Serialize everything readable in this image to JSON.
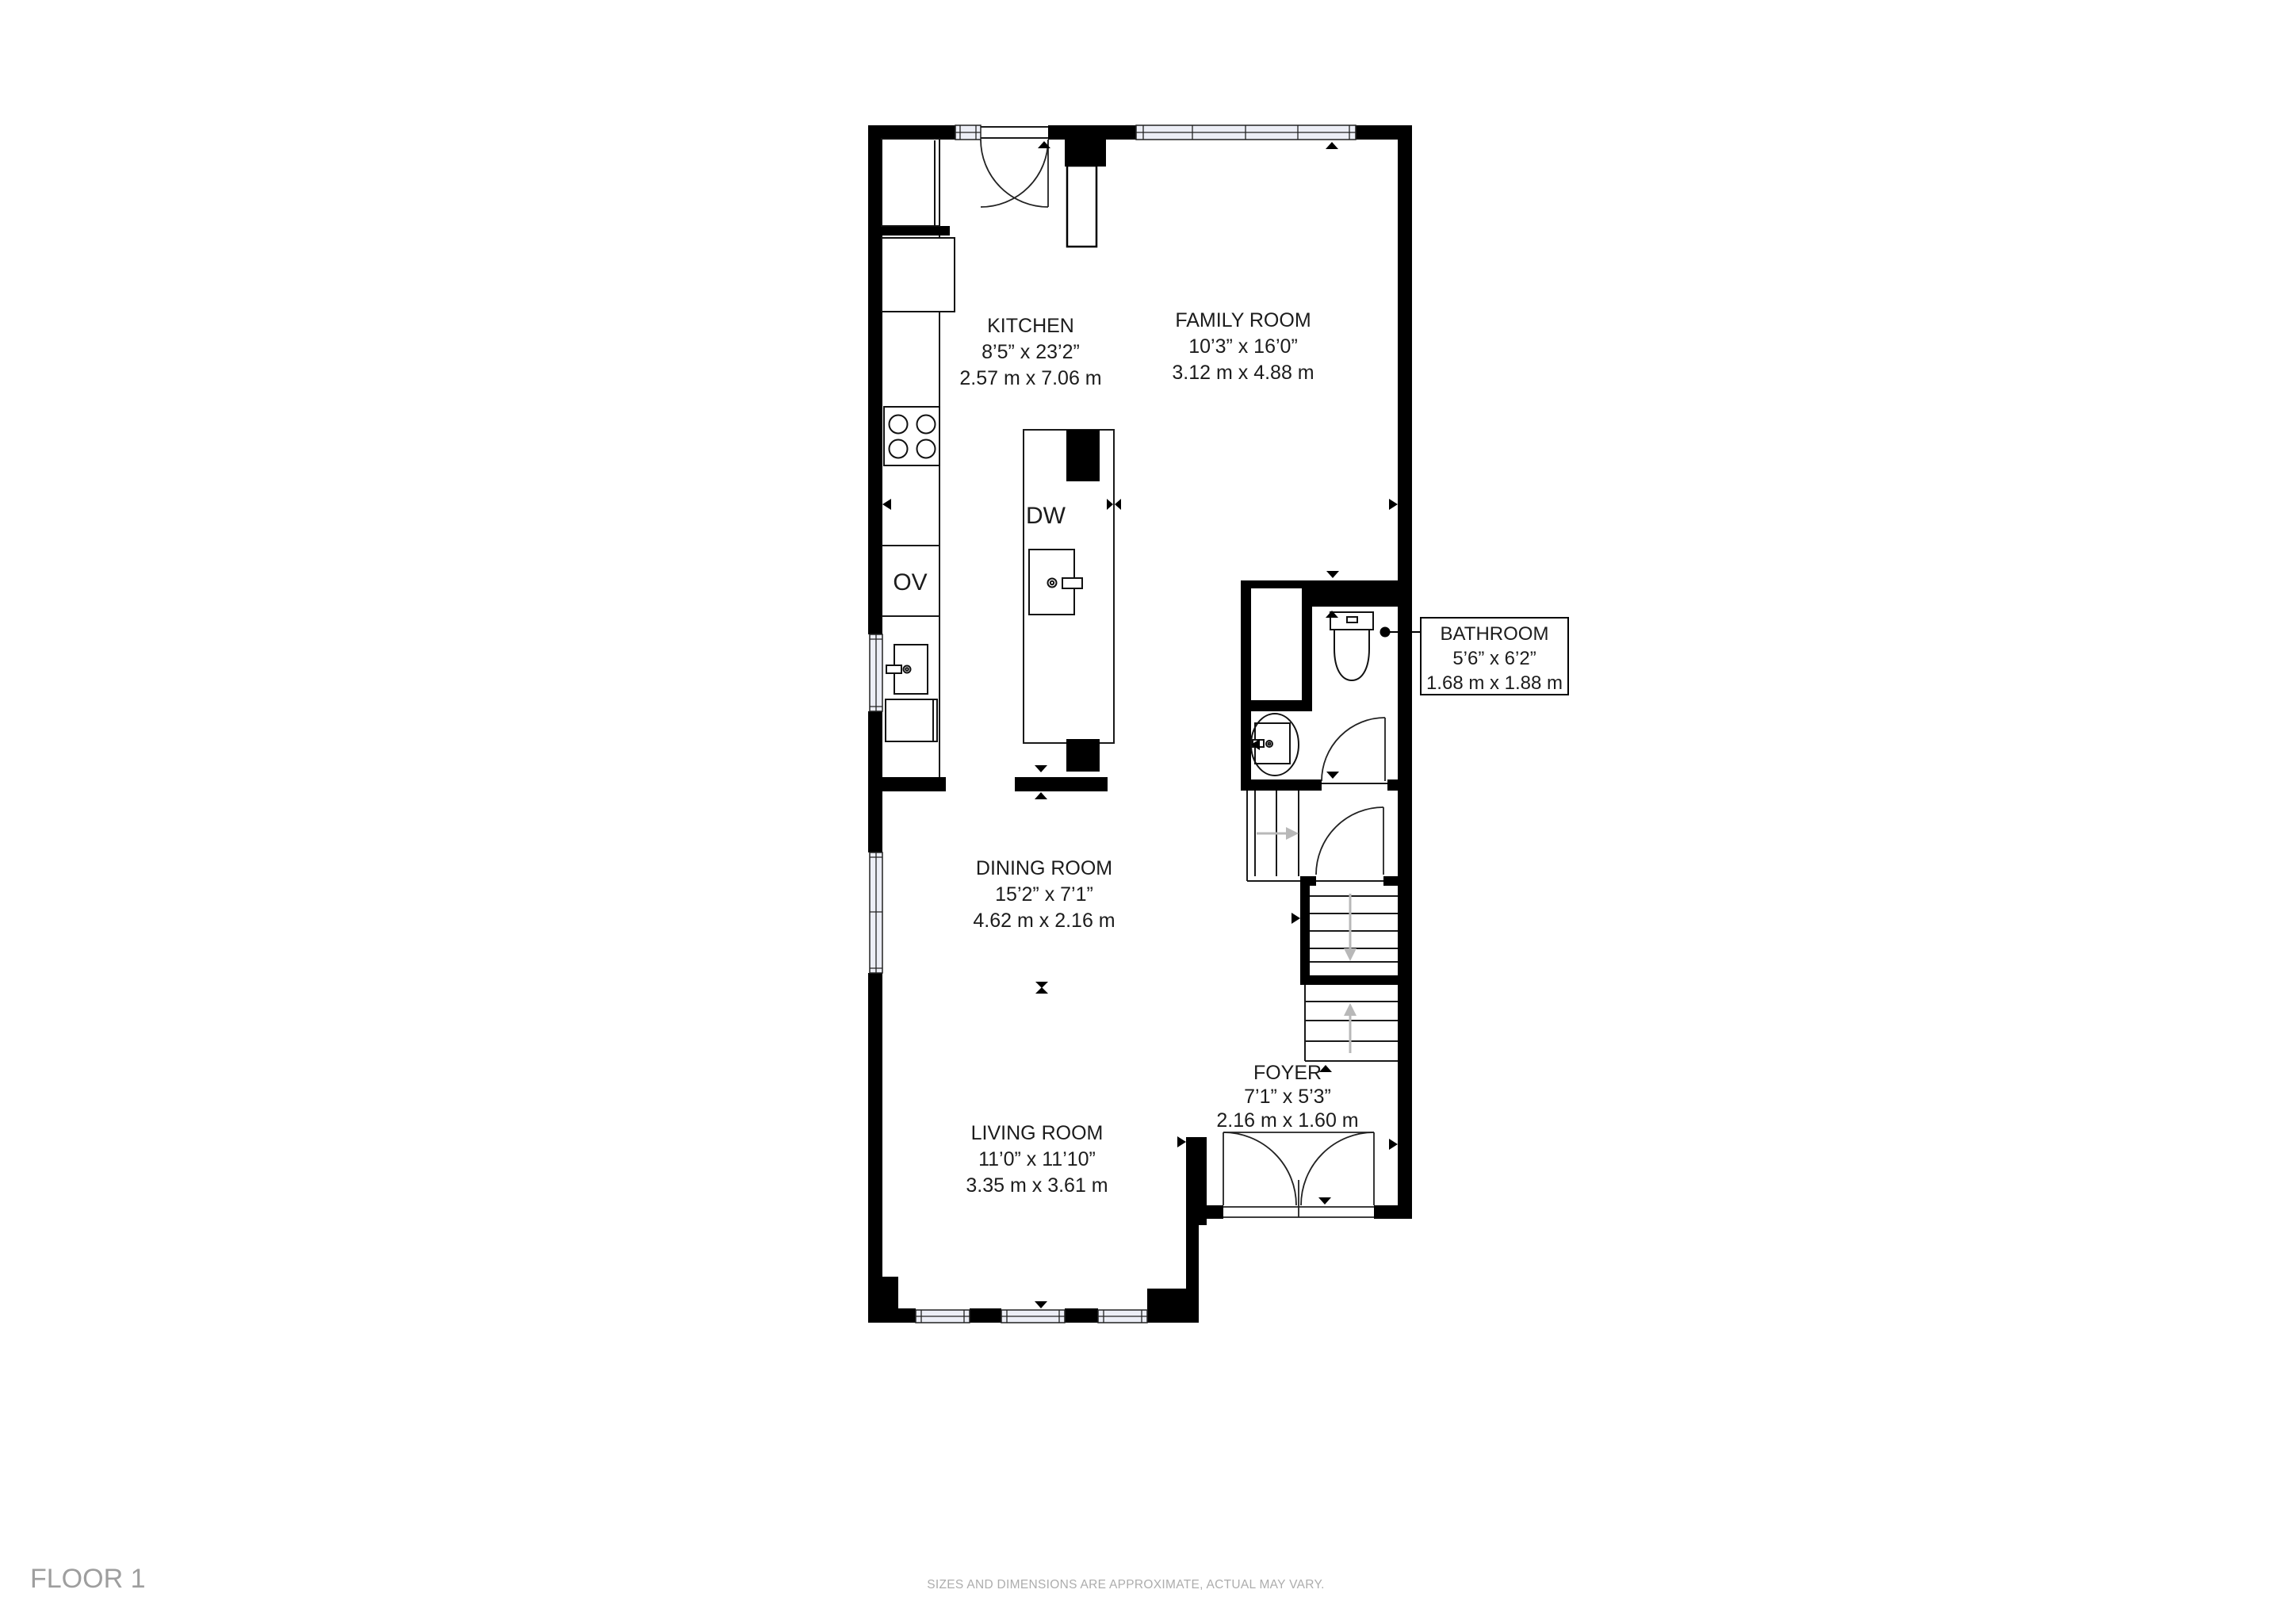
{
  "floor_label": "FLOOR 1",
  "disclaimer": "SIZES AND DIMENSIONS ARE APPROXIMATE, ACTUAL MAY VARY.",
  "rooms": [
    {
      "id": "kitchen",
      "name": "KITCHEN",
      "imperial": "8’5” x 23’2”",
      "metric": "2.57 m x 7.06 m"
    },
    {
      "id": "family-room",
      "name": "FAMILY ROOM",
      "imperial": "10’3” x 16’0”",
      "metric": "3.12 m x 4.88 m"
    },
    {
      "id": "bathroom",
      "name": "BATHROOM",
      "imperial": "5’6” x 6’2”",
      "metric": "1.68 m x 1.88 m"
    },
    {
      "id": "dining-room",
      "name": "DINING ROOM",
      "imperial": "15’2” x 7’1”",
      "metric": "4.62 m x 2.16 m"
    },
    {
      "id": "foyer",
      "name": "FOYER",
      "imperial": "7’1” x 5’3”",
      "metric": "2.16 m x 1.60 m"
    },
    {
      "id": "living-room",
      "name": "LIVING ROOM",
      "imperial": "11’0” x 11’10”",
      "metric": "3.35 m x 3.61 m"
    }
  ],
  "appliances": {
    "dishwasher": "DW",
    "oven": "OV"
  },
  "colors": {
    "wall": "#000000",
    "window_fill": "#eceef6",
    "label_text": "#1c1c1c",
    "muted_text": "#adadad",
    "floor_text": "#9e9e9e",
    "stair_arrow": "#b8b8b8",
    "background": "#ffffff"
  }
}
